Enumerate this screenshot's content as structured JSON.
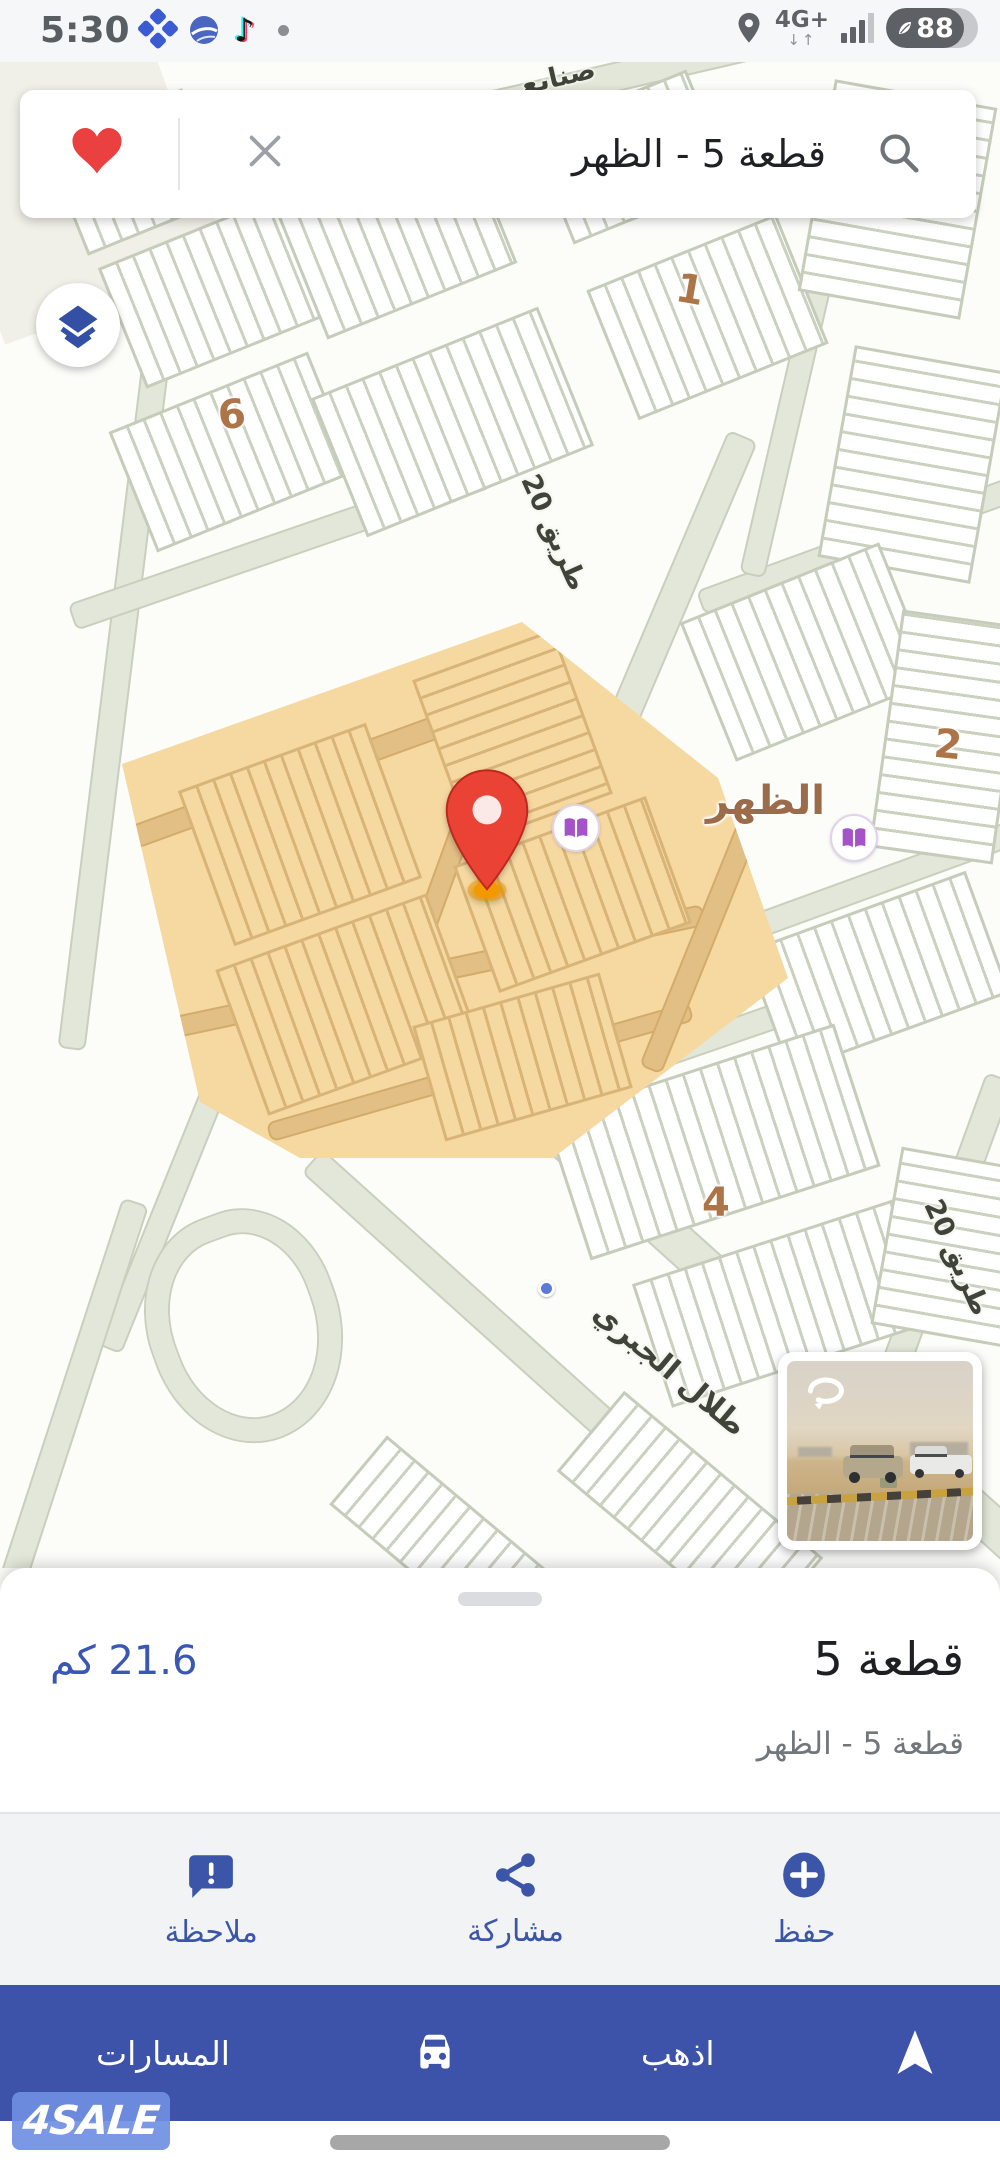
{
  "status_bar": {
    "time": "5:30",
    "network_type": "4G+",
    "network_arrows": "↓↑",
    "battery_level": "88"
  },
  "search_bar": {
    "query": "قطعة 5 - الظهر"
  },
  "map": {
    "district_label": "الظهر",
    "block_numbers": [
      "1",
      "6",
      "2",
      "4"
    ],
    "road_labels": {
      "road_20_upper": "طريق 20",
      "road_20_lower": "طريق 20",
      "jabri_street": "طلال الجبري",
      "top_partial": "صنايع"
    }
  },
  "bottom_sheet": {
    "title": "قطعة 5",
    "distance": "21.6 كم",
    "subtitle": "قطعة 5 - الظهر",
    "actions": [
      {
        "label": "حفظ",
        "icon": "add-circle-icon"
      },
      {
        "label": "مشاركة",
        "icon": "share-icon"
      },
      {
        "label": "ملاحظة",
        "icon": "note-icon"
      }
    ]
  },
  "bottom_bar": {
    "go_label": "اذهب",
    "routes_label": "المسارات"
  },
  "watermark": "4SALE",
  "colors": {
    "accent_blue": "#3b55a8",
    "bottom_bar_blue": "#3d52a9",
    "highlight_orange": "#f6d8a1",
    "pin_red": "#ea4335",
    "poi_purple": "#a453c8",
    "label_brown": "#ad7448"
  }
}
